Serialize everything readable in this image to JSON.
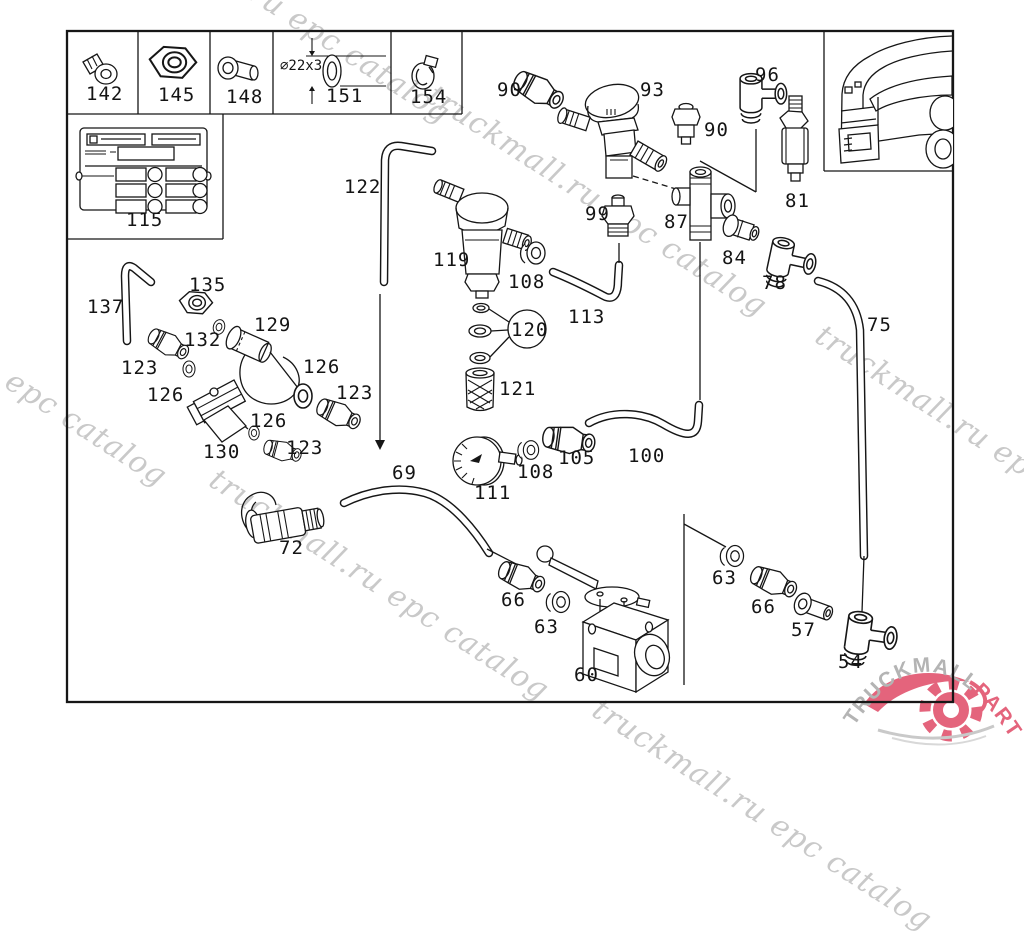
{
  "watermark": {
    "text": "truckmall.ru epc catalog",
    "color": "#c9c9c9"
  },
  "logo": {
    "text_gray": "TRUCKMALL",
    "text_pink": "PARTS",
    "gray": "#b4b4b4",
    "pink": "#e4647c"
  },
  "colors": {
    "ink": "#161616",
    "background": "#ffffff"
  },
  "parts": [
    {
      "label": "142"
    },
    {
      "label": "145"
    },
    {
      "label": "148"
    },
    {
      "label": "151",
      "dim_note": "⌀22x3"
    },
    {
      "label": "154"
    },
    {
      "label": "115"
    },
    {
      "label": "90"
    },
    {
      "label": "93"
    },
    {
      "label": "96"
    },
    {
      "label": "90"
    },
    {
      "label": "81"
    },
    {
      "label": "99"
    },
    {
      "label": "87"
    },
    {
      "label": "84"
    },
    {
      "label": "78"
    },
    {
      "label": "75"
    },
    {
      "label": "122"
    },
    {
      "label": "119"
    },
    {
      "label": "108"
    },
    {
      "label": "113"
    },
    {
      "label": "120"
    },
    {
      "label": "121"
    },
    {
      "label": "137"
    },
    {
      "label": "135"
    },
    {
      "label": "132"
    },
    {
      "label": "129"
    },
    {
      "label": "123"
    },
    {
      "label": "126"
    },
    {
      "label": "126"
    },
    {
      "label": "123"
    },
    {
      "label": "130"
    },
    {
      "label": "126"
    },
    {
      "label": "123"
    },
    {
      "label": "111"
    },
    {
      "label": "108"
    },
    {
      "label": "105"
    },
    {
      "label": "100"
    },
    {
      "label": "69"
    },
    {
      "label": "72"
    },
    {
      "label": "66"
    },
    {
      "label": "63"
    },
    {
      "label": "60"
    },
    {
      "label": "63"
    },
    {
      "label": "66"
    },
    {
      "label": "57"
    },
    {
      "label": "54"
    }
  ]
}
